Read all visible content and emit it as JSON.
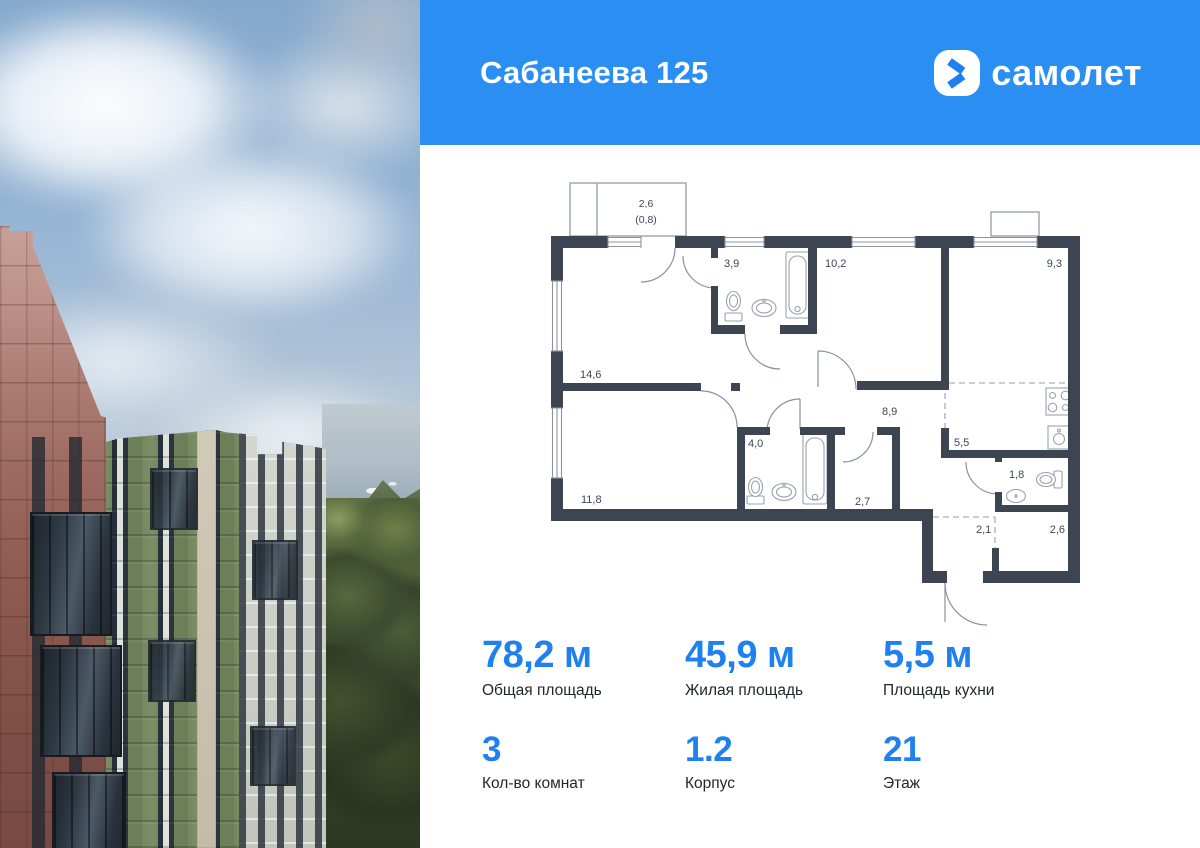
{
  "header": {
    "title": "Сабанеева 125",
    "brand": "самолет"
  },
  "brand_colors": {
    "header_blue": "#2b8ef2",
    "accent_blue": "#1f80f0",
    "wall_dark": "#3d4452"
  },
  "floorplan": {
    "labels": {
      "balcony": "2,6",
      "balcony_coef": "(0,8)",
      "bath_top": "3,9",
      "room_mid": "10,2",
      "room_right": "9,3",
      "living": "14,6",
      "hall": "8,9",
      "bath_low": "4,0",
      "kitchen": "5,5",
      "wc": "1,8",
      "room_left": "11,8",
      "storage": "2,7",
      "hall_small": "2,1",
      "hall_right": "2,6"
    }
  },
  "stats": {
    "items": [
      {
        "value": "78,2 м",
        "label": "Общая площадь"
      },
      {
        "value": "45,9 м",
        "label": "Жилая площадь"
      },
      {
        "value": "5,5 м",
        "label": "Площадь кухни"
      },
      {
        "value": "3",
        "label": "Кол-во комнат"
      },
      {
        "value": "1.2",
        "label": "Корпус"
      },
      {
        "value": "21",
        "label": "Этаж"
      }
    ]
  }
}
